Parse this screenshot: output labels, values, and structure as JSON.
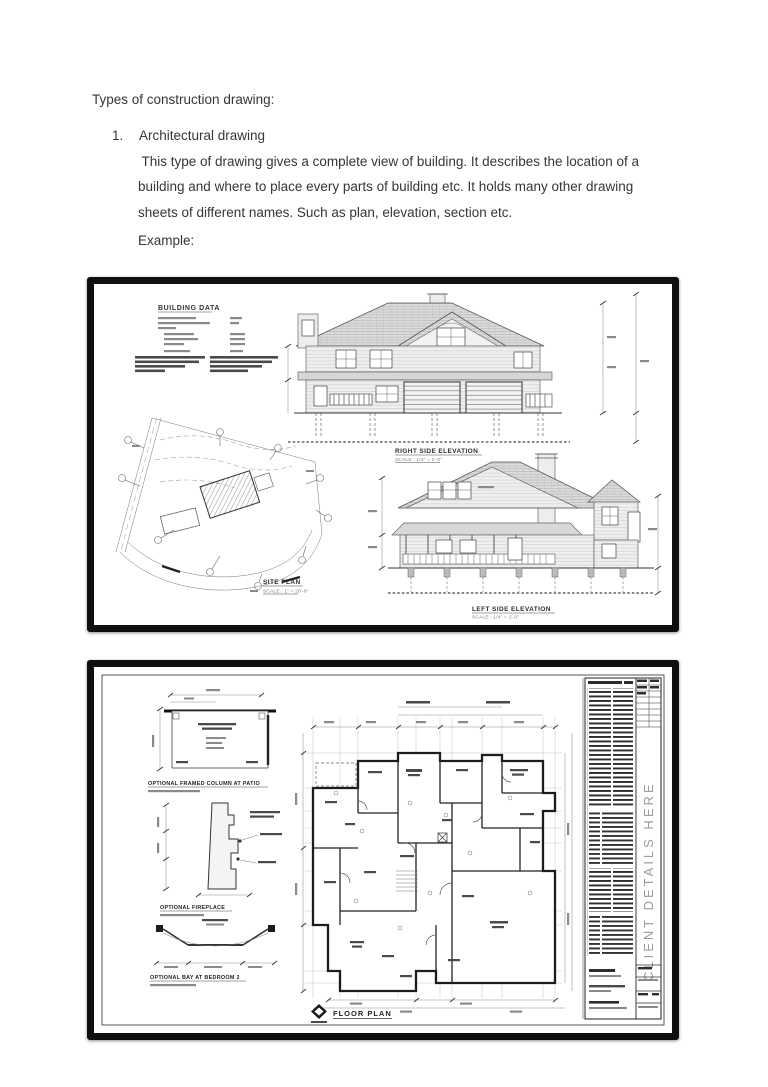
{
  "page": {
    "heading": "Types of construction drawing:",
    "item_number": "1.",
    "item_title": "Architectural drawing",
    "body_line1": " This type of drawing gives a complete view of building. It describes the location of a",
    "body_line2": "building and where to place every parts of building etc. It holds many other drawing",
    "body_line3": "sheets of different names. Such as plan, elevation, section etc.",
    "example_label": "Example:"
  },
  "figure1": {
    "building_data_title": "BUILDING DATA",
    "right_elevation_label": "RIGHT SIDE ELEVATION",
    "right_elevation_scale": "SCALE : 1/4\" = 1'-0\"",
    "left_elevation_label": "LEFT SIDE ELEVATION",
    "left_elevation_scale": "SCALE : 1/4\" = 1'-0\"",
    "site_plan_label": "SITE PLAN",
    "site_plan_scale": "SCALE : 1\" = 20'-0\""
  },
  "figure2": {
    "detail_column_label": "OPTIONAL FRAMED COLUMN AT PATIO",
    "detail_fireplace_label": "OPTIONAL FIREPLACE",
    "detail_bay_label": "OPTIONAL BAY AT BEDROOM 2",
    "floor_plan_label": "FLOOR PLAN",
    "client_details_text": "CLIENT DETAILS HERE"
  }
}
